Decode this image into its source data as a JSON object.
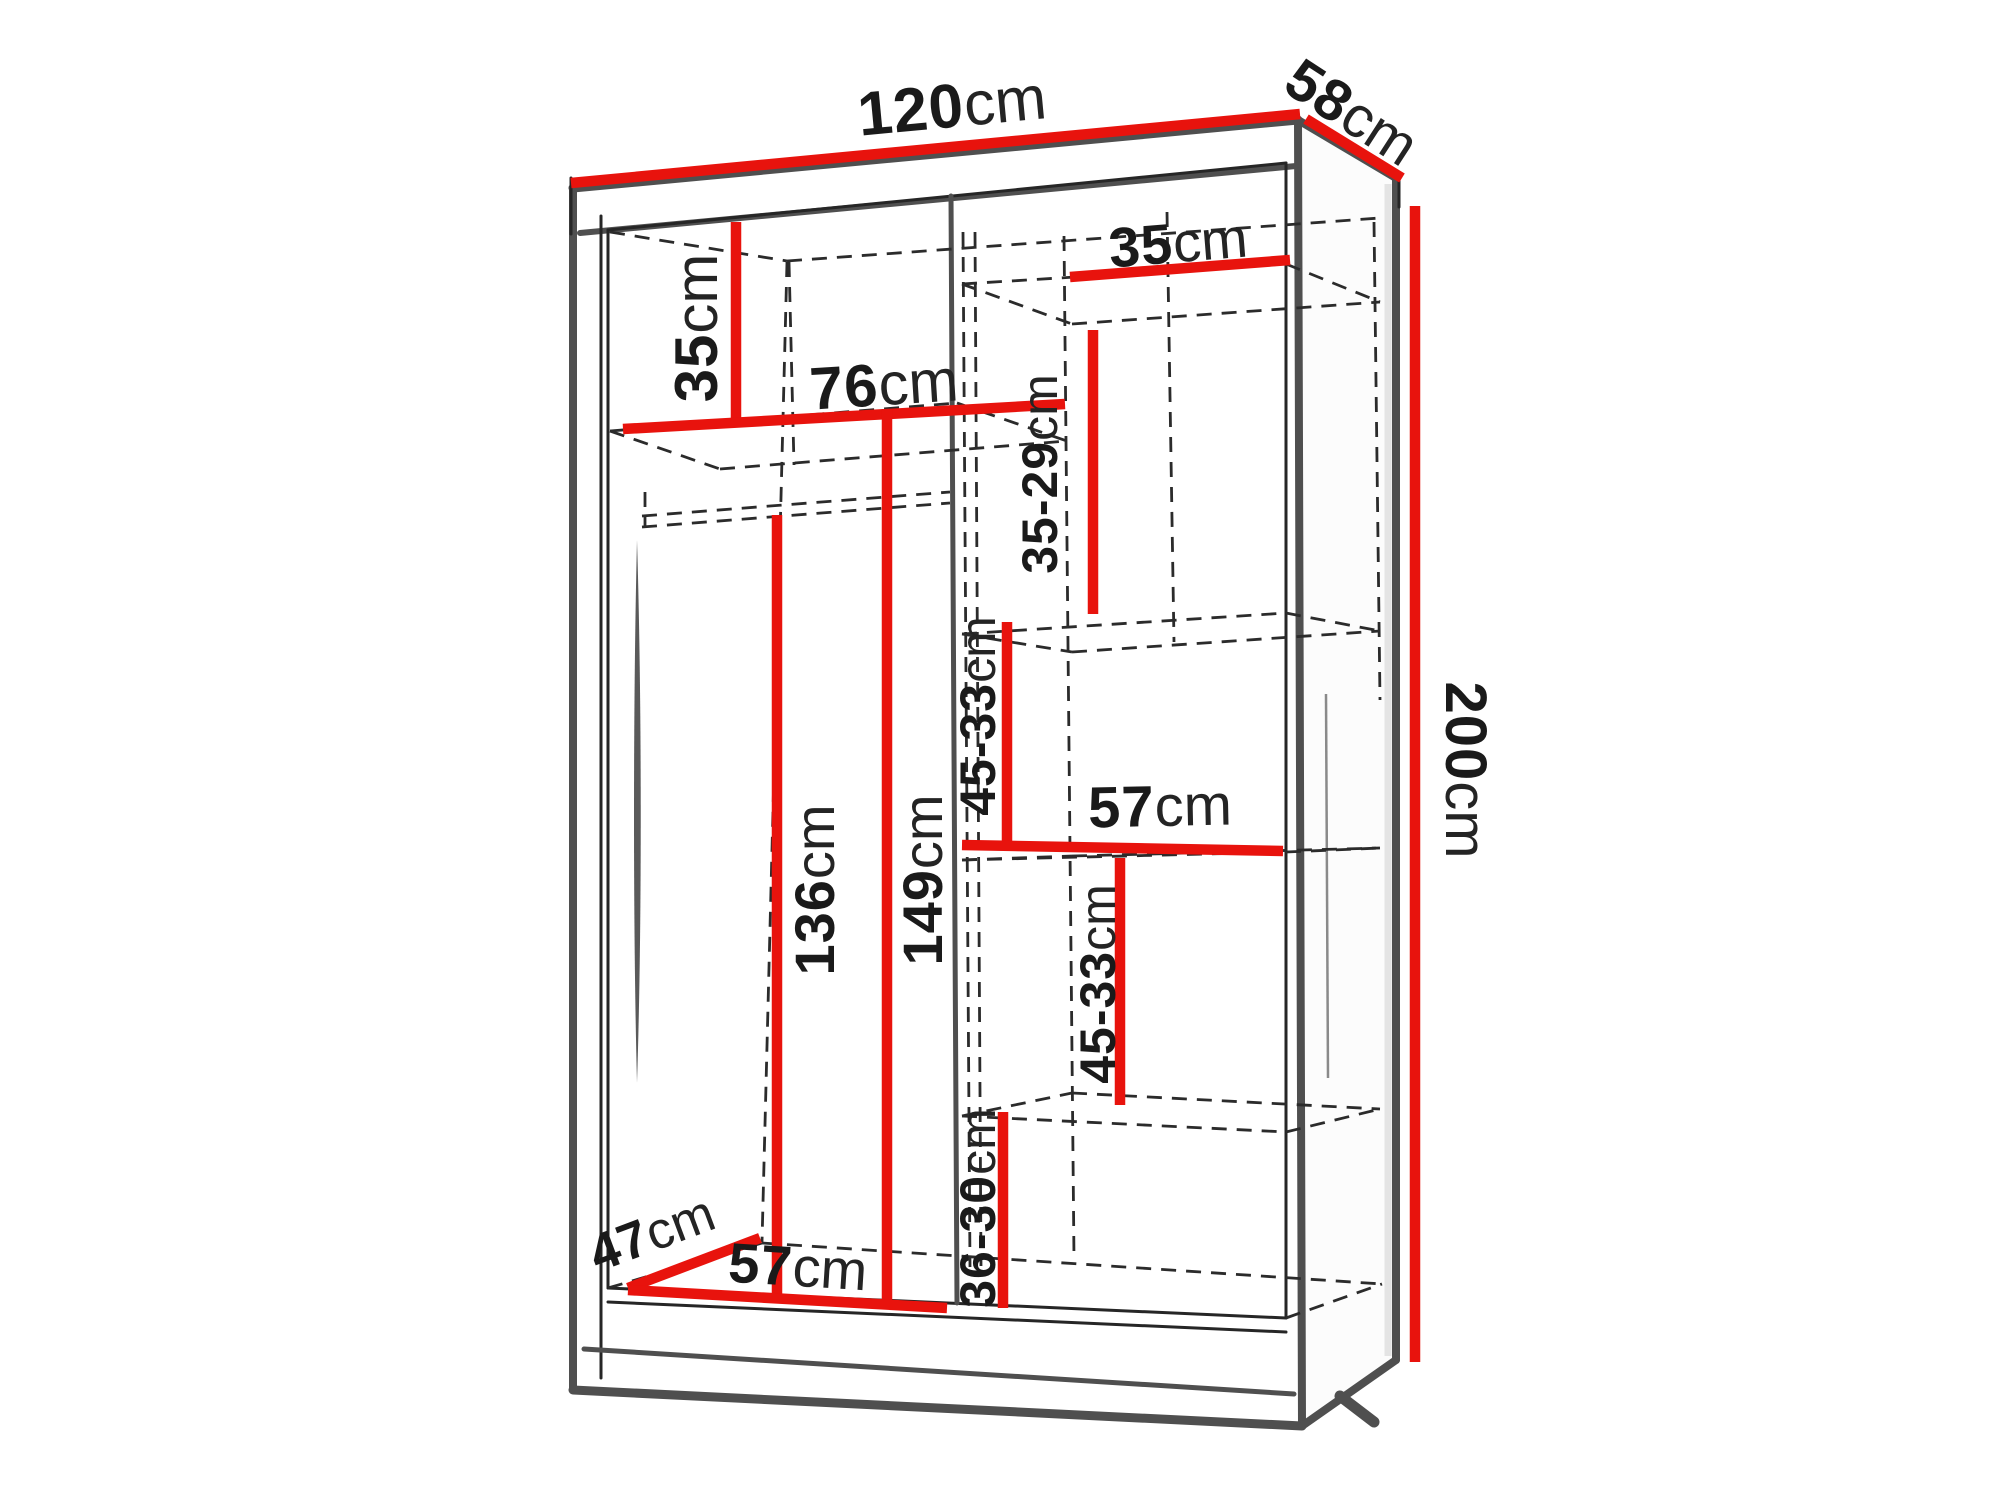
{
  "figure": {
    "type": "technical-drawing",
    "subject": "two-door sliding wardrobe interior dimensions",
    "unit_system": "centimeters"
  },
  "colors": {
    "dimension_line": "#e8130d",
    "outline": "#4f4f4f",
    "hidden_edge": "#2b2b2b",
    "text": "#1a1a1a",
    "background": "#ffffff"
  },
  "dimensions": [
    {
      "id": "overall-width",
      "value": "120",
      "unit": "cm"
    },
    {
      "id": "overall-depth",
      "value": "58",
      "unit": "cm"
    },
    {
      "id": "overall-height",
      "value": "200",
      "unit": "cm"
    },
    {
      "id": "left-top-compartment-height",
      "value": "35",
      "unit": "cm"
    },
    {
      "id": "upper-shelf-width",
      "value": "76",
      "unit": "cm"
    },
    {
      "id": "right-top-shelf-width",
      "value": "35",
      "unit": "cm"
    },
    {
      "id": "right-shelf-spacing-upper",
      "value": "35-29",
      "unit": "cm"
    },
    {
      "id": "right-shelf-spacing-middle",
      "value": "45-33",
      "unit": "cm"
    },
    {
      "id": "right-middle-shelf-width",
      "value": "57",
      "unit": "cm"
    },
    {
      "id": "right-shelf-spacing-lower",
      "value": "45-33",
      "unit": "cm"
    },
    {
      "id": "right-bottom-compartment-height",
      "value": "36-30",
      "unit": "cm"
    },
    {
      "id": "hanging-space-height",
      "value": "136",
      "unit": "cm"
    },
    {
      "id": "left-compartment-height",
      "value": "149",
      "unit": "cm"
    },
    {
      "id": "interior-depth",
      "value": "47",
      "unit": "cm"
    },
    {
      "id": "left-bottom-compartment-width",
      "value": "57",
      "unit": "cm"
    }
  ]
}
